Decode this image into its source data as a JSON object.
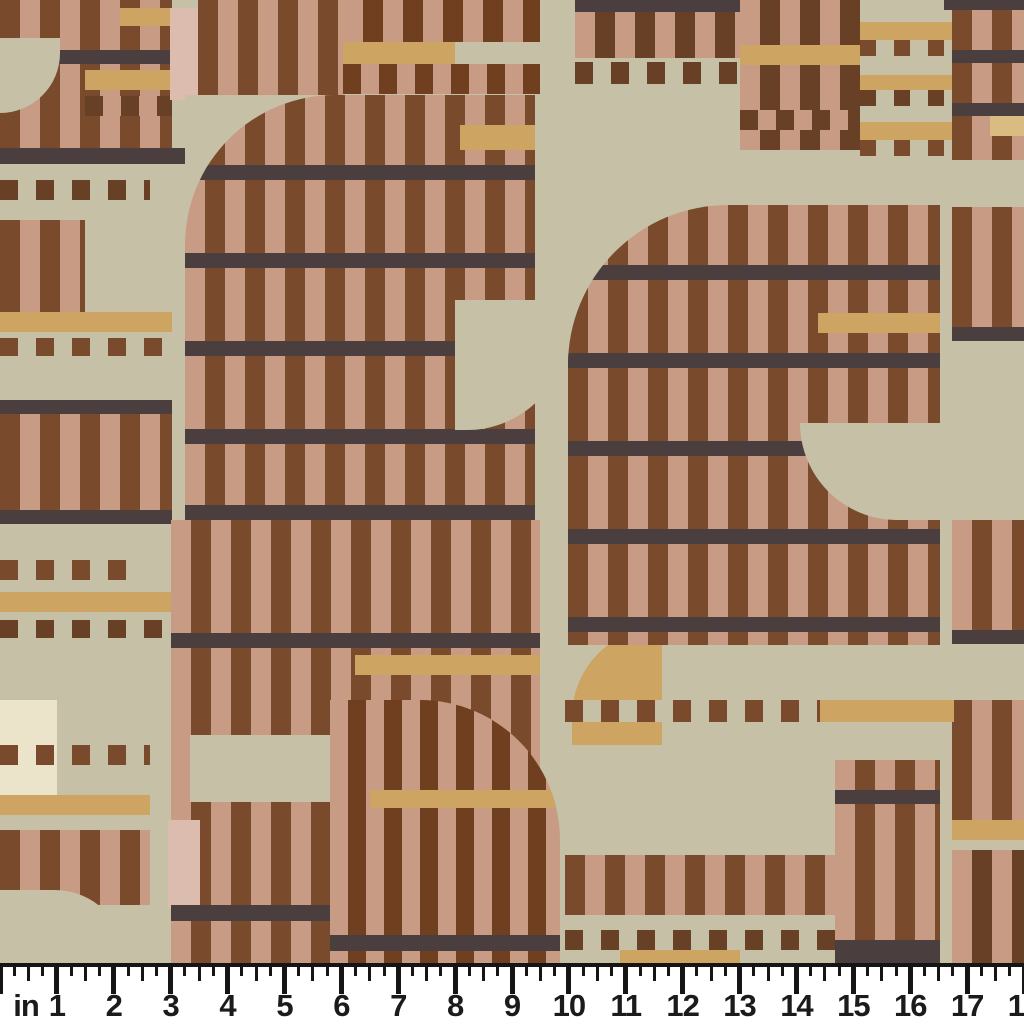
{
  "meta": {
    "description_label": "fabric swatch with inch ruler"
  },
  "palette": {
    "ch": "#4b3e3e",
    "ru": "#7a4a2d",
    "rd": "#6f3f20",
    "cn": "#684026",
    "pk": "#c89b85",
    "pp": "#dcbcae",
    "cm": "#cda461",
    "cp": "#d9bc82",
    "sg": "#c6c0a6",
    "cr": "#ece4ca",
    "tr": "transparent",
    "ruler_bg": "#ffffff",
    "ruler_ink": "#151515"
  },
  "swatch": {
    "width": 1024,
    "height": 963,
    "base": "sg",
    "patches": [
      {
        "t": "v",
        "x": 0,
        "y": 0,
        "w": 172,
        "h": 148,
        "bg": "pk",
        "fg": "ru"
      },
      {
        "t": "s",
        "x": 120,
        "y": 8,
        "w": 75,
        "h": 18,
        "bg": "cm"
      },
      {
        "t": "s",
        "x": 0,
        "y": 50,
        "w": 172,
        "h": 14,
        "bg": "ch"
      },
      {
        "t": "s",
        "x": 85,
        "y": 70,
        "w": 87,
        "h": 20,
        "bg": "cm"
      },
      {
        "t": "v",
        "x": 85,
        "y": 96,
        "w": 87,
        "h": 20,
        "bg": "pk",
        "fg": "cn",
        "sw": 18,
        "pd": 36
      },
      {
        "t": "s",
        "x": 0,
        "y": 38,
        "w": 60,
        "h": 75,
        "bg": "sg",
        "corner": "br",
        "r": 60
      },
      {
        "t": "s",
        "x": 170,
        "y": 8,
        "w": 30,
        "h": 92,
        "bg": "pp"
      },
      {
        "t": "v",
        "x": 198,
        "y": 0,
        "w": 145,
        "h": 150,
        "bg": "pk",
        "fg": "ru"
      },
      {
        "t": "v",
        "x": 343,
        "y": 0,
        "w": 197,
        "h": 42,
        "bg": "rd",
        "fg": "pk"
      },
      {
        "t": "s",
        "x": 343,
        "y": 42,
        "w": 112,
        "h": 22,
        "bg": "cm"
      },
      {
        "t": "v",
        "x": 343,
        "y": 64,
        "w": 197,
        "h": 30,
        "bg": "pk",
        "fg": "rd",
        "sw": 18,
        "pd": 36
      },
      {
        "t": "s",
        "x": 0,
        "y": 148,
        "w": 185,
        "h": 16,
        "bg": "ch"
      },
      {
        "t": "s",
        "x": 185,
        "y": 95,
        "w": 355,
        "h": 58,
        "bg": "sg"
      },
      {
        "t": "s",
        "x": 185,
        "y": 152,
        "w": 120,
        "h": 180,
        "bg": "sg"
      },
      {
        "t": "v",
        "x": 0,
        "y": 180,
        "w": 150,
        "h": 20,
        "bg": "sg",
        "fg": "cn",
        "sw": 18,
        "pd": 36
      },
      {
        "t": "v",
        "x": 0,
        "y": 220,
        "w": 85,
        "h": 92,
        "bg": "pk",
        "fg": "ru"
      },
      {
        "t": "s",
        "x": 0,
        "y": 312,
        "w": 172,
        "h": 20,
        "bg": "cm"
      },
      {
        "t": "v",
        "x": 0,
        "y": 338,
        "w": 172,
        "h": 18,
        "bg": "sg",
        "fg": "ru",
        "sw": 18,
        "pd": 36
      },
      {
        "t": "v",
        "x": 185,
        "y": 95,
        "w": 350,
        "h": 425,
        "bg": "ru",
        "fg": "pk",
        "corner": "tl",
        "r": 150,
        "kids": [
          {
            "t": "s",
            "x": 0,
            "y": 70,
            "w": 350,
            "h": 15,
            "bg": "ch"
          },
          {
            "t": "s",
            "x": 0,
            "y": 158,
            "w": 350,
            "h": 15,
            "bg": "ch"
          },
          {
            "t": "s",
            "x": 0,
            "y": 246,
            "w": 350,
            "h": 15,
            "bg": "ch"
          },
          {
            "t": "s",
            "x": 0,
            "y": 334,
            "w": 350,
            "h": 15,
            "bg": "ch"
          },
          {
            "t": "s",
            "x": 0,
            "y": 410,
            "w": 350,
            "h": 15,
            "bg": "ch"
          },
          {
            "t": "s",
            "x": 275,
            "y": 30,
            "w": 75,
            "h": 25,
            "bg": "cm"
          }
        ]
      },
      {
        "t": "s",
        "x": 455,
        "y": 300,
        "w": 112,
        "h": 130,
        "bg": "sg",
        "corner": "br",
        "r": 100
      },
      {
        "t": "s",
        "x": 0,
        "y": 400,
        "w": 172,
        "h": 14,
        "bg": "ch"
      },
      {
        "t": "v",
        "x": 0,
        "y": 414,
        "w": 172,
        "h": 96,
        "bg": "pk",
        "fg": "ru"
      },
      {
        "t": "s",
        "x": 0,
        "y": 510,
        "w": 172,
        "h": 14,
        "bg": "ch"
      },
      {
        "t": "v",
        "x": 0,
        "y": 560,
        "w": 140,
        "h": 20,
        "bg": "sg",
        "fg": "ru",
        "sw": 18,
        "pd": 36
      },
      {
        "t": "s",
        "x": 0,
        "y": 592,
        "w": 172,
        "h": 20,
        "bg": "cm"
      },
      {
        "t": "v",
        "x": 0,
        "y": 620,
        "w": 172,
        "h": 18,
        "bg": "sg",
        "fg": "cn",
        "sw": 18,
        "pd": 36
      },
      {
        "t": "s",
        "x": 0,
        "y": 700,
        "w": 57,
        "h": 110,
        "bg": "cr"
      },
      {
        "t": "v",
        "x": 0,
        "y": 745,
        "w": 150,
        "h": 20,
        "bg": "tr",
        "fg": "ru",
        "sw": 18,
        "pd": 36
      },
      {
        "t": "s",
        "x": 0,
        "y": 795,
        "w": 150,
        "h": 20,
        "bg": "cm"
      },
      {
        "t": "v",
        "x": 0,
        "y": 830,
        "w": 150,
        "h": 75,
        "bg": "pk",
        "fg": "ru"
      },
      {
        "t": "s",
        "x": 0,
        "y": 890,
        "w": 125,
        "h": 73,
        "bg": "sg",
        "corner": "tr",
        "r": 70
      },
      {
        "t": "v",
        "x": 171,
        "y": 520,
        "w": 369,
        "h": 400,
        "bg": "ru",
        "fg": "pk"
      },
      {
        "t": "s",
        "x": 171,
        "y": 633,
        "w": 369,
        "h": 15,
        "bg": "ch"
      },
      {
        "t": "s",
        "x": 355,
        "y": 655,
        "w": 185,
        "h": 20,
        "bg": "cm"
      },
      {
        "t": "s",
        "x": 190,
        "y": 735,
        "w": 145,
        "h": 67,
        "bg": "sg"
      },
      {
        "t": "s",
        "x": 168,
        "y": 820,
        "w": 32,
        "h": 88,
        "bg": "pp"
      },
      {
        "t": "s",
        "x": 400,
        "y": 838,
        "w": 140,
        "h": 20,
        "bg": "cm"
      },
      {
        "t": "s",
        "x": 171,
        "y": 905,
        "w": 369,
        "h": 16,
        "bg": "ch"
      },
      {
        "t": "v",
        "x": 171,
        "y": 921,
        "w": 369,
        "h": 42,
        "bg": "ru",
        "fg": "pk"
      },
      {
        "t": "v",
        "x": 330,
        "y": 700,
        "w": 230,
        "h": 263,
        "bg": "rd",
        "fg": "pk",
        "sw": 18,
        "pd": 36,
        "corner": "tr",
        "r": 140,
        "kids": [
          {
            "t": "s",
            "x": 0,
            "y": 235,
            "w": 230,
            "h": 16,
            "bg": "ch"
          },
          {
            "t": "s",
            "x": 40,
            "y": 90,
            "w": 190,
            "h": 18,
            "bg": "cm"
          }
        ]
      },
      {
        "t": "s",
        "x": 572,
        "y": 627,
        "w": 90,
        "h": 118,
        "bg": "cm",
        "corner": "tl",
        "r": 90
      },
      {
        "t": "s",
        "x": 575,
        "y": 0,
        "w": 165,
        "h": 12,
        "bg": "ch"
      },
      {
        "t": "v",
        "x": 575,
        "y": 12,
        "w": 165,
        "h": 46,
        "bg": "cn",
        "fg": "pk"
      },
      {
        "t": "v",
        "x": 575,
        "y": 62,
        "w": 165,
        "h": 22,
        "bg": "sg",
        "fg": "cn",
        "sw": 18,
        "pd": 36
      },
      {
        "t": "v",
        "x": 740,
        "y": 0,
        "w": 212,
        "h": 150,
        "bg": "cn",
        "fg": "pk"
      },
      {
        "t": "s",
        "x": 740,
        "y": 45,
        "w": 122,
        "h": 20,
        "bg": "cm"
      },
      {
        "t": "v",
        "x": 740,
        "y": 110,
        "w": 212,
        "h": 20,
        "bg": "pk",
        "fg": "cn",
        "sw": 18,
        "pd": 36
      },
      {
        "t": "s",
        "x": 860,
        "y": 0,
        "w": 92,
        "h": 150,
        "bg": "sg"
      },
      {
        "t": "s",
        "x": 860,
        "y": 22,
        "w": 92,
        "h": 18,
        "bg": "cm"
      },
      {
        "t": "v",
        "x": 860,
        "y": 40,
        "w": 92,
        "h": 16,
        "bg": "sg",
        "fg": "ru",
        "sw": 16,
        "pd": 34
      },
      {
        "t": "s",
        "x": 860,
        "y": 75,
        "w": 92,
        "h": 15,
        "bg": "cm"
      },
      {
        "t": "v",
        "x": 860,
        "y": 90,
        "w": 92,
        "h": 16,
        "bg": "sg",
        "fg": "cn",
        "sw": 16,
        "pd": 34
      },
      {
        "t": "s",
        "x": 860,
        "y": 122,
        "w": 92,
        "h": 18,
        "bg": "cm"
      },
      {
        "t": "v",
        "x": 860,
        "y": 140,
        "w": 92,
        "h": 16,
        "bg": "sg",
        "fg": "ru",
        "sw": 16,
        "pd": 34
      },
      {
        "t": "v",
        "x": 952,
        "y": 0,
        "w": 72,
        "h": 160,
        "bg": "pk",
        "fg": "ru"
      },
      {
        "t": "s",
        "x": 944,
        "y": 0,
        "w": 80,
        "h": 10,
        "bg": "ch"
      },
      {
        "t": "s",
        "x": 952,
        "y": 50,
        "w": 72,
        "h": 13,
        "bg": "ch"
      },
      {
        "t": "s",
        "x": 952,
        "y": 103,
        "w": 72,
        "h": 13,
        "bg": "ch"
      },
      {
        "t": "s",
        "x": 990,
        "y": 116,
        "w": 34,
        "h": 20,
        "bg": "cp"
      },
      {
        "t": "s",
        "x": 952,
        "y": 160,
        "w": 72,
        "h": 47,
        "bg": "sg"
      },
      {
        "t": "v",
        "x": 952,
        "y": 207,
        "w": 72,
        "h": 120,
        "bg": "pk",
        "fg": "ru"
      },
      {
        "t": "s",
        "x": 952,
        "y": 327,
        "w": 72,
        "h": 14,
        "bg": "ch"
      },
      {
        "t": "v",
        "x": 568,
        "y": 205,
        "w": 372,
        "h": 440,
        "bg": "pk",
        "fg": "ru",
        "corner": "tl",
        "r": 160,
        "kids": [
          {
            "t": "s",
            "x": 0,
            "y": 60,
            "w": 372,
            "h": 15,
            "bg": "ch"
          },
          {
            "t": "s",
            "x": 0,
            "y": 148,
            "w": 372,
            "h": 15,
            "bg": "ch"
          },
          {
            "t": "s",
            "x": 0,
            "y": 236,
            "w": 372,
            "h": 15,
            "bg": "ch"
          },
          {
            "t": "s",
            "x": 0,
            "y": 324,
            "w": 372,
            "h": 15,
            "bg": "ch"
          },
          {
            "t": "s",
            "x": 0,
            "y": 412,
            "w": 372,
            "h": 15,
            "bg": "ch"
          },
          {
            "t": "s",
            "x": 250,
            "y": 108,
            "w": 122,
            "h": 20,
            "bg": "cm"
          }
        ]
      },
      {
        "t": "s",
        "x": 800,
        "y": 423,
        "w": 224,
        "h": 97,
        "bg": "sg",
        "corner": "bl",
        "r": 97
      },
      {
        "t": "v",
        "x": 952,
        "y": 520,
        "w": 72,
        "h": 110,
        "bg": "ru",
        "fg": "pk"
      },
      {
        "t": "s",
        "x": 952,
        "y": 630,
        "w": 72,
        "h": 14,
        "bg": "ch"
      },
      {
        "t": "v",
        "x": 952,
        "y": 700,
        "w": 72,
        "h": 120,
        "bg": "pk",
        "fg": "ru"
      },
      {
        "t": "s",
        "x": 952,
        "y": 820,
        "w": 72,
        "h": 20,
        "bg": "cm"
      },
      {
        "t": "v",
        "x": 952,
        "y": 850,
        "w": 72,
        "h": 113,
        "bg": "cn",
        "fg": "pk"
      },
      {
        "t": "v",
        "x": 565,
        "y": 700,
        "w": 270,
        "h": 22,
        "bg": "sg",
        "fg": "ru",
        "sw": 18,
        "pd": 36
      },
      {
        "t": "s",
        "x": 820,
        "y": 700,
        "w": 134,
        "h": 22,
        "bg": "cm"
      },
      {
        "t": "v",
        "x": 565,
        "y": 855,
        "w": 270,
        "h": 60,
        "bg": "pk",
        "fg": "ru"
      },
      {
        "t": "v",
        "x": 565,
        "y": 930,
        "w": 270,
        "h": 20,
        "bg": "sg",
        "fg": "cn",
        "sw": 18,
        "pd": 36
      },
      {
        "t": "s",
        "x": 620,
        "y": 950,
        "w": 120,
        "h": 13,
        "bg": "cm"
      },
      {
        "t": "v",
        "x": 835,
        "y": 760,
        "w": 105,
        "h": 203,
        "bg": "ru",
        "fg": "pk"
      },
      {
        "t": "s",
        "x": 835,
        "y": 790,
        "w": 105,
        "h": 14,
        "bg": "ch"
      },
      {
        "t": "s",
        "x": 835,
        "y": 940,
        "w": 105,
        "h": 23,
        "bg": "ch"
      }
    ]
  },
  "ruler": {
    "unit_label": "in",
    "labels": [
      "in",
      "1",
      "2",
      "3",
      "4",
      "5",
      "6",
      "7",
      "8",
      "9",
      "10",
      "11",
      "12",
      "13",
      "14",
      "15",
      "16",
      "17",
      "18"
    ],
    "px_per_inch": 56.889,
    "subdivisions_per_inch": 4,
    "total_inches": 18
  }
}
